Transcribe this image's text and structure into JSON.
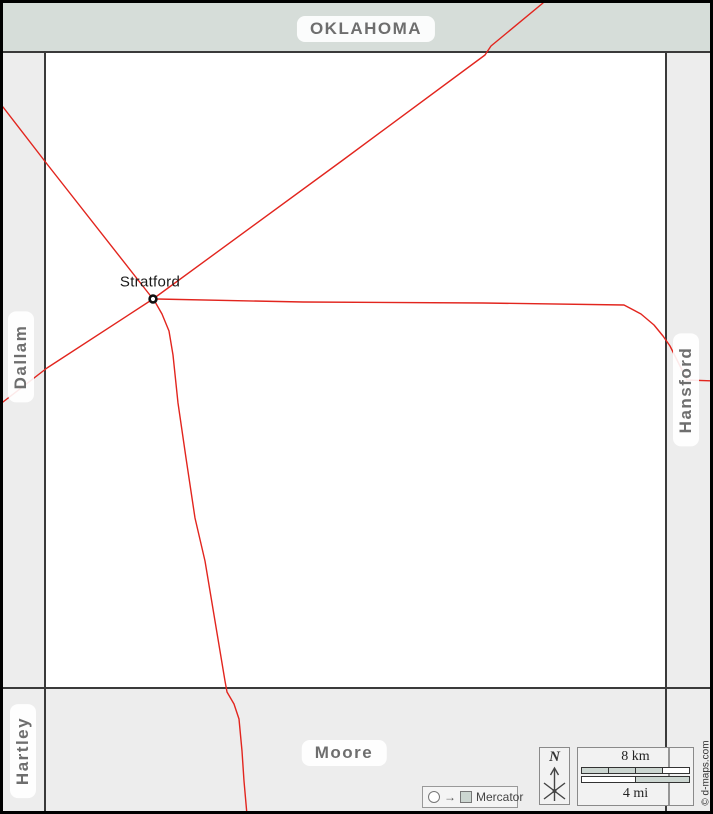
{
  "labels": {
    "north_region": "OKLAHOMA",
    "west_region": "Dallam",
    "east_region": "Hansford",
    "southwest_region": "Hartley",
    "south_region": "Moore",
    "city": "Stratford"
  },
  "legend": {
    "compass_label": "N",
    "scale_km": "8 km",
    "scale_mi": "4 mi",
    "projection": "Mercator",
    "projection_arrow": "→",
    "credit": "© d-maps.com"
  },
  "colors": {
    "north_band": "#d6ddd9",
    "side_band": "#ededed",
    "county_fill": "#ffffff",
    "county_border": "#3a3a3a",
    "road": "#e2251e",
    "region_label_text": "#6e6e6e",
    "scale_segment_fill": "#ccd6d1"
  },
  "city_marker": {
    "x": 150,
    "y": 296
  },
  "roads": [
    {
      "name": "road-northwest",
      "points": [
        [
          0,
          104
        ],
        [
          44,
          161
        ],
        [
          150,
          296
        ]
      ]
    },
    {
      "name": "road-northeast",
      "points": [
        [
          150,
          296
        ],
        [
          340,
          157
        ],
        [
          482,
          52
        ],
        [
          488,
          43
        ],
        [
          540,
          0
        ]
      ]
    },
    {
      "name": "road-southwest",
      "points": [
        [
          150,
          296
        ],
        [
          44,
          365
        ],
        [
          0,
          399
        ]
      ]
    },
    {
      "name": "road-south",
      "points": [
        [
          151,
          297
        ],
        [
          159,
          311
        ],
        [
          166,
          328
        ],
        [
          170,
          352
        ],
        [
          175,
          400
        ],
        [
          183,
          455
        ],
        [
          192,
          515
        ],
        [
          202,
          558
        ],
        [
          212,
          618
        ],
        [
          222,
          678
        ],
        [
          224,
          689
        ],
        [
          231,
          701
        ],
        [
          236,
          716
        ],
        [
          239,
          748
        ],
        [
          241,
          778
        ],
        [
          244,
          812
        ]
      ]
    },
    {
      "name": "road-east",
      "points": [
        [
          154,
          296
        ],
        [
          300,
          299
        ],
        [
          480,
          300
        ],
        [
          621,
          302
        ],
        [
          638,
          311
        ],
        [
          651,
          322
        ],
        [
          660,
          333
        ],
        [
          667,
          343
        ],
        [
          675,
          359
        ],
        [
          681,
          371
        ],
        [
          684,
          377
        ],
        [
          711,
          378
        ]
      ]
    }
  ]
}
